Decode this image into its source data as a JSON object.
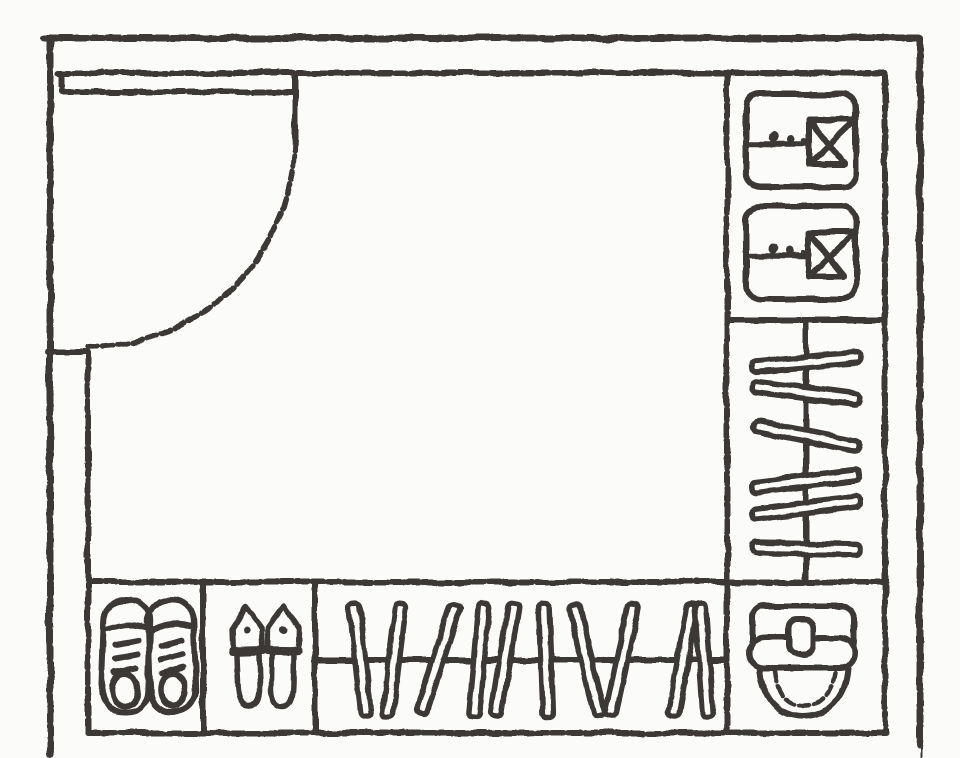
{
  "canvas": {
    "width": 960,
    "height": 758,
    "background": "#fbfbfa",
    "ink": "#3a3836"
  },
  "plan": {
    "type": "floorplan",
    "description": "Hand-drawn floor plan of an entryway cloakroom: entry door with swing arc, shelf with folded shirts, two hanging rails with clothes hangers, shoe cubbies with sneakers and slippers, and a bag cubby",
    "zones": [
      {
        "id": "room",
        "label": "cloakroom interior"
      },
      {
        "id": "entry-door",
        "label": "entry door with 90-degree swing arc"
      },
      {
        "id": "shirt-shelf",
        "label": "folded shirts shelf (top right)",
        "item_count": 2
      },
      {
        "id": "side-rail",
        "label": "hanging rail with hangers (right)",
        "item_count": 6
      },
      {
        "id": "sneaker-cubby",
        "label": "sneaker cubby (bottom left)",
        "item_count": 2
      },
      {
        "id": "slipper-cubby",
        "label": "slipper cubby (bottom left)",
        "item_count": 2
      },
      {
        "id": "bottom-rail",
        "label": "hanging rail with hangers (bottom)",
        "item_count": 10
      },
      {
        "id": "bag-cubby",
        "label": "bag cubby (bottom right)",
        "item_count": 1
      }
    ]
  },
  "symbols": {
    "shirts": [
      {
        "x": 746,
        "y": 94
      },
      {
        "x": 746,
        "y": 206
      }
    ],
    "side_rail": {
      "rod_x": 806,
      "rod_y1": 324,
      "rod_y2": 580,
      "bar_length": 108,
      "bar_width": 11,
      "bars": [
        {
          "cy": 362,
          "angle": -5
        },
        {
          "cy": 393,
          "angle": 7
        },
        {
          "cy": 436,
          "angle": 11
        },
        {
          "cy": 481,
          "angle": -7
        },
        {
          "cy": 508,
          "angle": -7
        },
        {
          "cy": 549,
          "angle": 1
        }
      ]
    },
    "bottom_rail": {
      "rod_y": 660,
      "rod_x1": 318,
      "rod_x2": 725,
      "bar_length": 114,
      "bar_width": 11,
      "bars": [
        {
          "cx": 360,
          "angle": -6
        },
        {
          "cx": 394,
          "angle": 7
        },
        {
          "cx": 438,
          "angle": 18
        },
        {
          "cx": 479,
          "angle": 5
        },
        {
          "cx": 505,
          "angle": 9
        },
        {
          "cx": 546,
          "angle": -2
        },
        {
          "cx": 587,
          "angle": -13
        },
        {
          "cx": 622,
          "angle": 12
        },
        {
          "cx": 683,
          "angle": 10
        },
        {
          "cx": 704,
          "angle": -4
        }
      ]
    },
    "sneakers": [
      {
        "cx": 126,
        "tilt": 2
      },
      {
        "cx": 172,
        "tilt": -2
      }
    ],
    "slippers": [
      {
        "cx": 248,
        "tilt": -2
      },
      {
        "cx": 283,
        "tilt": 1
      }
    ]
  }
}
